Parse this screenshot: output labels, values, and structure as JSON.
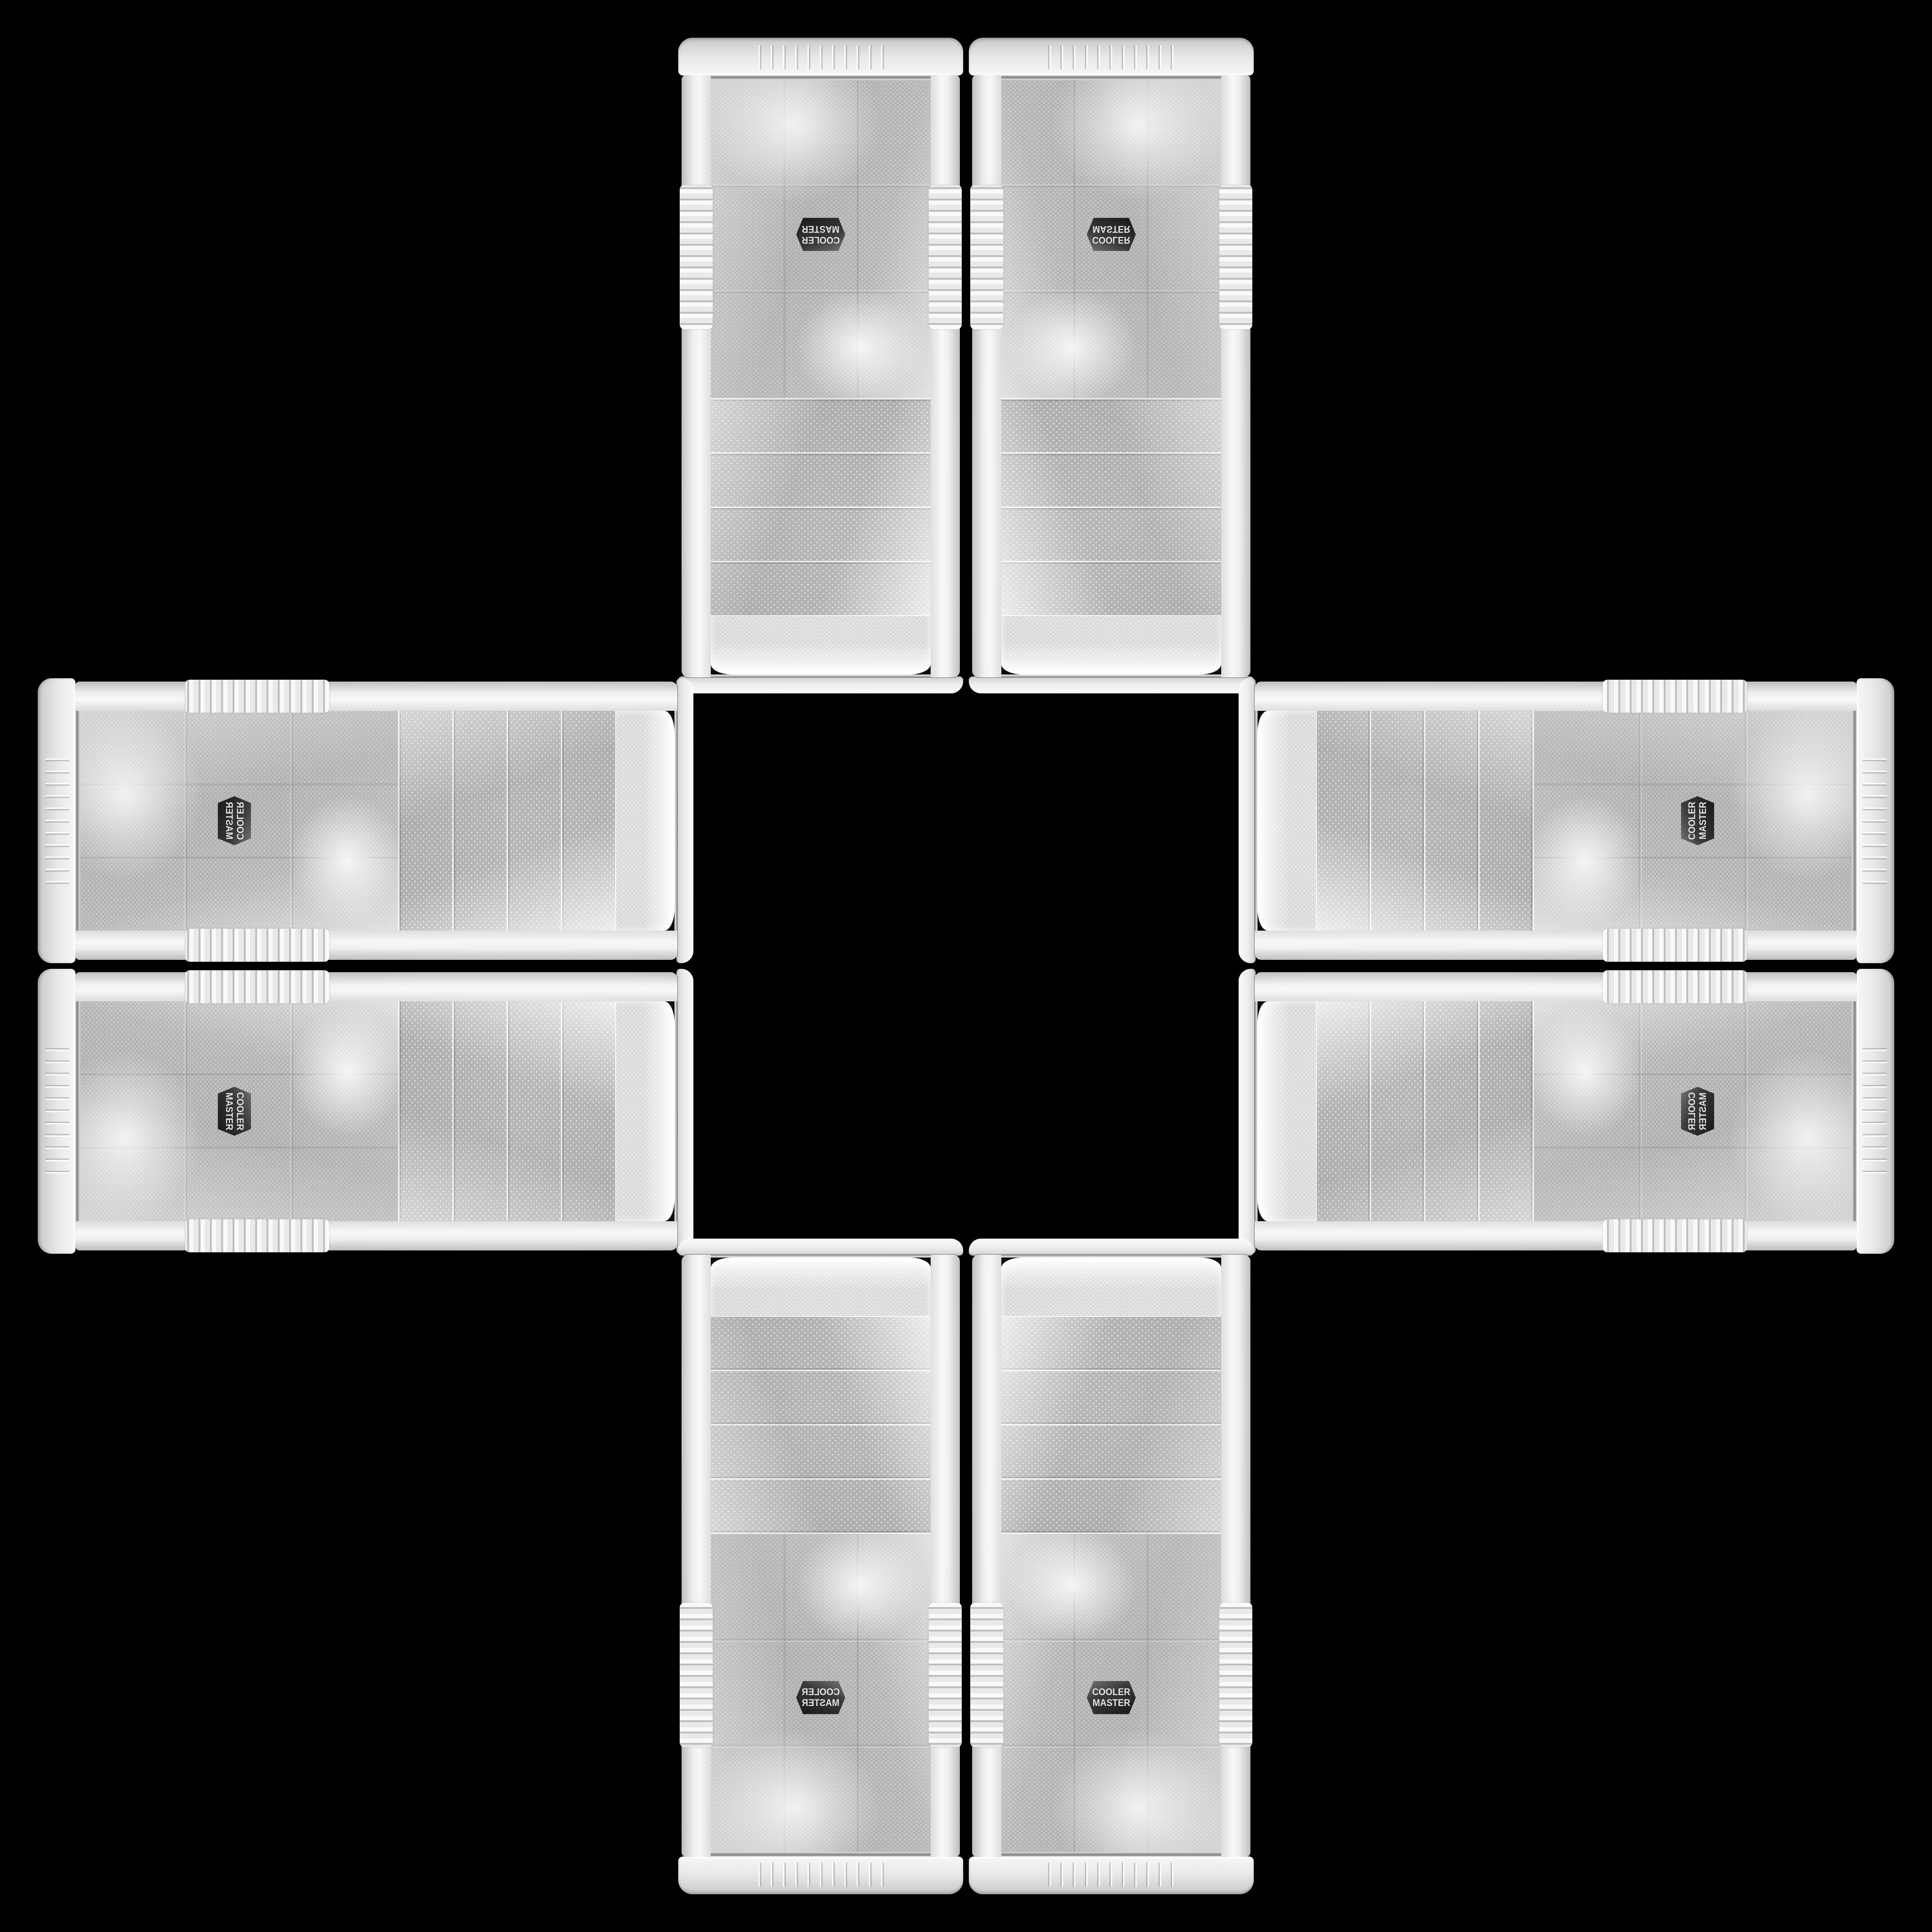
{
  "scene": {
    "description": "Eight identical white Cooler Master computer-case front panels arranged in a plus (cross) pattern on a solid black background. Each arm of the cross holds two parallel panels; panels are rotated or mirrored so the Cooler Master badge always sits toward the outer edge of the cross.",
    "background_color": "#000000",
    "panel_color": "#efefef",
    "mesh_dot_color": "#b6b6b6",
    "chrome_trim_color": "#9c9c9c",
    "badge": {
      "line1": "COOLER",
      "line2": "MASTER",
      "background_color": "#2d2d2d",
      "text_color": "#e6e6e6"
    },
    "panels": [
      {
        "id": "top-left",
        "arm": "top",
        "orientation": "vertical, rotated 180°, badge upside-down near top"
      },
      {
        "id": "top-right",
        "arm": "top",
        "orientation": "vertical, flipped vertically, badge mirrored upside-down near top"
      },
      {
        "id": "left-top",
        "arm": "left",
        "orientation": "horizontal, badge rotated with mirrored text near left"
      },
      {
        "id": "left-bottom",
        "arm": "left",
        "orientation": "horizontal, badge rotated 90° near left"
      },
      {
        "id": "right-top",
        "arm": "right",
        "orientation": "horizontal, badge rotated 90° clockwise near right"
      },
      {
        "id": "right-bottom",
        "arm": "right",
        "orientation": "horizontal, badge rotated with mirrored text near right"
      },
      {
        "id": "bottom-left",
        "arm": "bottom",
        "orientation": "vertical, mirrored, badge mirrored near bottom"
      },
      {
        "id": "bottom-right",
        "arm": "bottom",
        "orientation": "vertical, upright, badge readable near bottom"
      }
    ]
  }
}
